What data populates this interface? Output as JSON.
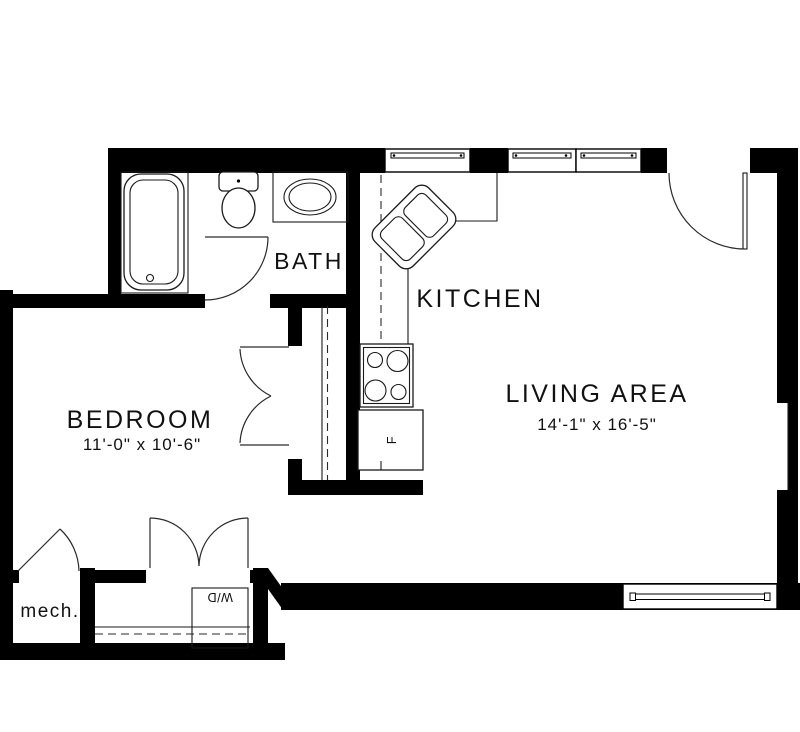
{
  "rooms": {
    "bedroom": {
      "label": "BEDROOM",
      "dimensions": "11'-0\" x 10'-6\""
    },
    "living_area": {
      "label": "LIVING AREA",
      "dimensions": "14'-1\" x 16'-5\""
    },
    "kitchen": {
      "label": "KITCHEN"
    },
    "bath": {
      "label": "BATH"
    },
    "mech": {
      "label": "mech."
    }
  },
  "fixtures": {
    "washer_dryer": "W/D",
    "refrigerator": "F"
  },
  "colors": {
    "wall": "#000000",
    "line": "#1a1a1a",
    "background": "#ffffff",
    "text": "#111111"
  }
}
